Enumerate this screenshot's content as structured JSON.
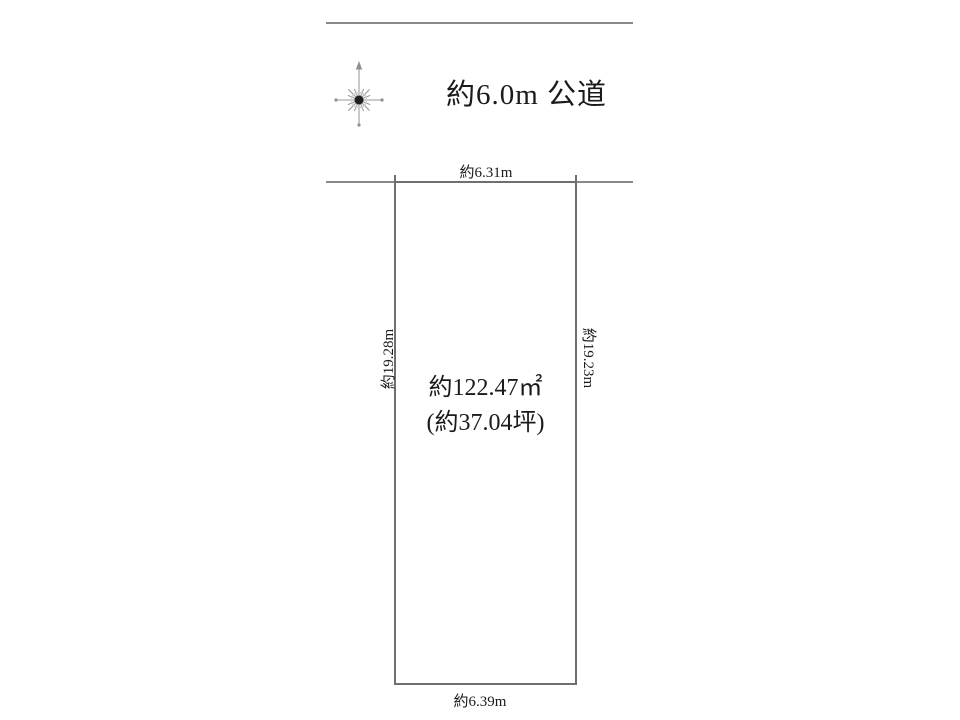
{
  "page": {
    "background_color": "#ffffff",
    "line_color": "#898989",
    "plot_border_color": "#6f6f6f",
    "text_color": "#1b1b1b"
  },
  "road": {
    "label": "約6.0m 公道"
  },
  "plot": {
    "top_dimension": "約6.31m",
    "bottom_dimension": "約6.39m",
    "left_dimension": "約19.28m",
    "right_dimension": "約19.23m",
    "area_sqm": "約122.47㎡",
    "area_tsubo": "(約37.04坪)"
  },
  "icons": {
    "compass": "compass-north-star-icon"
  }
}
